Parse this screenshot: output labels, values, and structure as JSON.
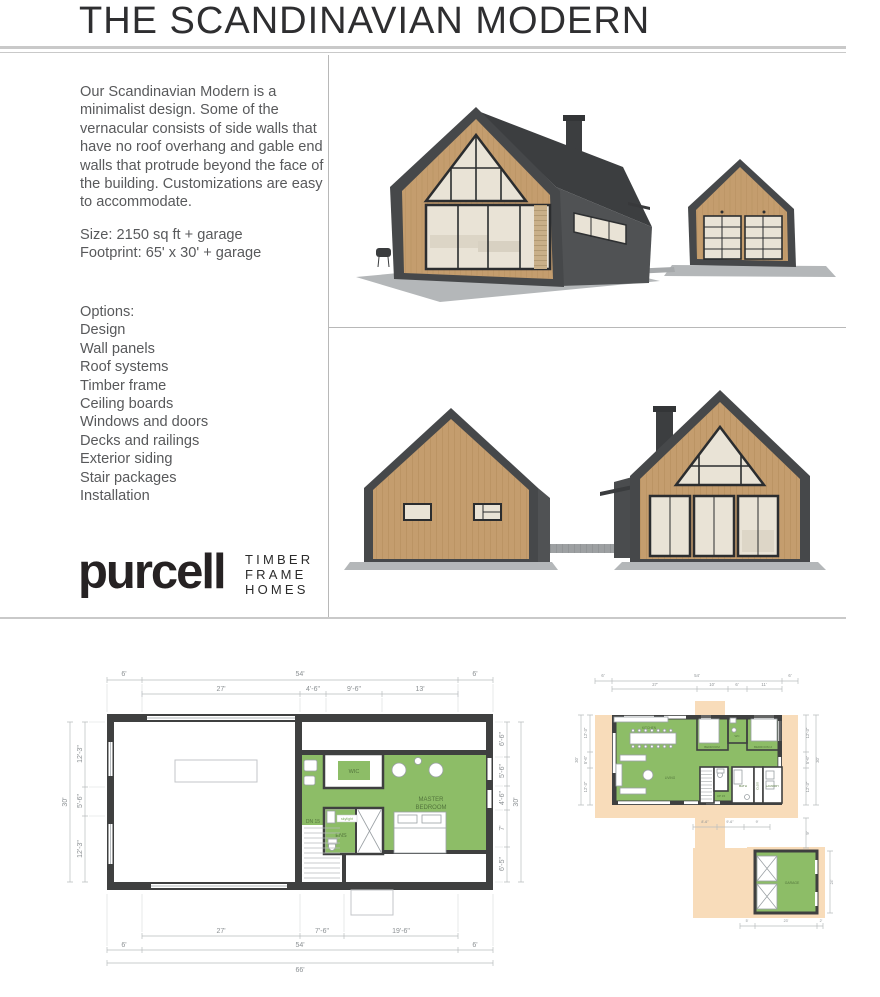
{
  "colors": {
    "green": "#8dbd67",
    "peach": "#f8dcba",
    "wall": "#3f4040",
    "wood": "#c49d6e",
    "dark": "#46484a",
    "darker": "#3c3e40",
    "side": "#505254",
    "glass": "#e9e3d6",
    "slab": "#b4b7b9",
    "text": "#58595b",
    "brand": "#262223",
    "rule": "#c9c9c9"
  },
  "header": {
    "title": "THE SCANDINAVIAN MODERN"
  },
  "intro": {
    "description": "Our Scandinavian Modern is a minimalist design. Some of the vernacular consists of side walls that have no roof overhang and gable end walls that protrude beyond the face of the building. Customizations are easy to accommodate.",
    "size_line": "Size: 2150 sq ft + garage",
    "footprint_line": "Footprint: 65' x 30' + garage"
  },
  "options": {
    "title": "Options:",
    "items": [
      "Design",
      "Wall panels",
      "Roof systems",
      "Timber frame",
      "Ceiling boards",
      "Windows and doors",
      "Decks and railings",
      "Exterior siding",
      "Stair packages",
      "Installation"
    ]
  },
  "logo": {
    "brand": "purcell",
    "tagline": [
      "TIMBER",
      "FRAME",
      "HOMES"
    ]
  },
  "plans": {
    "upper": {
      "top_row1": [
        "6'",
        "54'",
        "6'"
      ],
      "top_row2": [
        "27'",
        "4'-6\"",
        "9'-6\"",
        "13'"
      ],
      "left": [
        "12'-3\"",
        "5'-6\"",
        "12'-3\""
      ],
      "left_overall": "30'",
      "right": [
        "6'-6\"",
        "5'-6\"",
        "4'-6\"",
        "7'",
        "6'-5\""
      ],
      "right_overall": "30'",
      "bottom_row1": [
        "27'",
        "7'-6\"",
        "19'-6\""
      ],
      "bottom_row2": [
        "6'",
        "54'",
        "6'"
      ],
      "bottom_overall": "66'",
      "rooms": {
        "wic": "WIC",
        "master1": "MASTER",
        "master2": "BEDROOM",
        "ens": "ENS",
        "stairs": "DN 15",
        "skylight": "skylight"
      }
    },
    "main": {
      "top_row1": [
        "6'",
        "54'",
        "6'"
      ],
      "top_row2": [
        "27'",
        "10'",
        "6'",
        "11'"
      ],
      "left": [
        "12'-3\"",
        "5'-6\"",
        "12'-3\""
      ],
      "left_overall": "30'",
      "right": [
        "12'-3\"",
        "5'-6\"",
        "12'-3\""
      ],
      "right_overall": "30'",
      "right_lower": "9'",
      "walkway": [
        "8'-6\"",
        "9'-6\"",
        "9'"
      ],
      "garage_bottom": [
        "5'",
        "23'",
        "2'"
      ],
      "garage_right": "24'",
      "rooms": {
        "kitchen": "KITCHEN",
        "living": "LIVING",
        "bedroom": "BEDROOM",
        "wc": "WC",
        "bedroom2": "BEDROOM 2",
        "bath": "BATH",
        "clos": "CLOS",
        "laundry": "LAUNDRY",
        "stairs": "UP 15",
        "garage": "GARAGE"
      }
    }
  }
}
